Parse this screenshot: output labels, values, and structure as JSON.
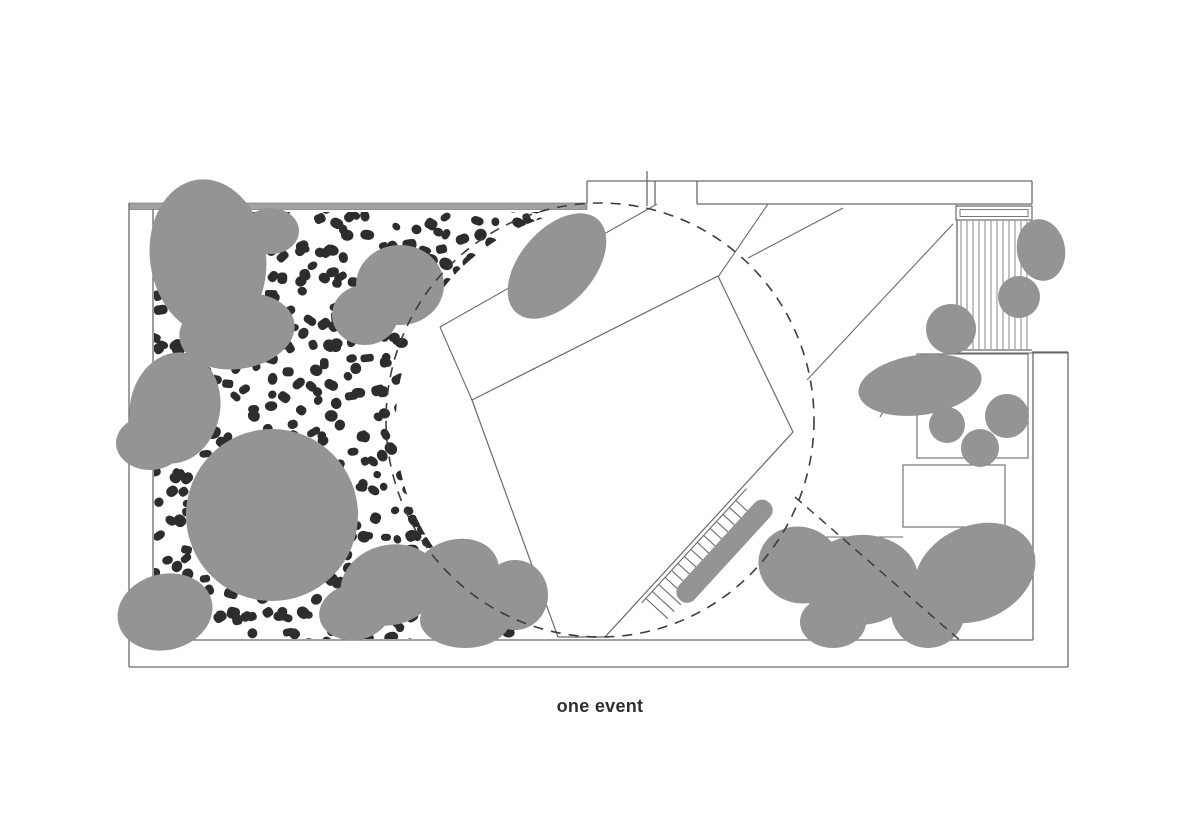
{
  "caption": {
    "text": "one event"
  },
  "palette": {
    "background": "#ffffff",
    "canopy": "#949494",
    "gravel": "#2d2d2d",
    "line": "#6a6a6a",
    "line_light": "#8a8a8a",
    "dash": "#3d3d3d",
    "band": "#a2a2a2",
    "caption": "#2f2f2f"
  },
  "plan": {
    "boundary_lines": [
      [
        129,
        203,
        129,
        667
      ],
      [
        129,
        667,
        1068,
        667
      ],
      [
        1068,
        667,
        1068,
        352
      ],
      [
        1068,
        352,
        1032,
        352
      ],
      [
        153,
        209,
        153,
        640
      ],
      [
        153,
        640,
        1033,
        640
      ],
      [
        1033,
        640,
        1033,
        353
      ],
      [
        587,
        203,
        587,
        181
      ],
      [
        587,
        181,
        655,
        181
      ],
      [
        655,
        181,
        1032,
        181
      ],
      [
        1032,
        181,
        1032,
        204
      ],
      [
        697,
        204,
        1032,
        204
      ],
      [
        655,
        181,
        655,
        205
      ],
      [
        697,
        181,
        697,
        204
      ],
      [
        647,
        171,
        647,
        206
      ],
      [
        957,
        205,
        957,
        352
      ],
      [
        957,
        350,
        1032,
        350
      ]
    ],
    "top_band": {
      "x": 129,
      "y": 203,
      "w": 458,
      "h": 6.5
    },
    "path_lines": [
      [
        440,
        327,
        657,
        204
      ],
      [
        440,
        327,
        472,
        400
      ],
      [
        718,
        277,
        768,
        204
      ],
      [
        748,
        258,
        843,
        208
      ],
      [
        953,
        224,
        807,
        380
      ],
      [
        880,
        417,
        917,
        355
      ],
      [
        778,
        537,
        903,
        537
      ]
    ],
    "beds": [
      {
        "x": 917,
        "y": 354,
        "w": 111,
        "h": 104
      },
      {
        "x": 903,
        "y": 465,
        "w": 102,
        "h": 62
      }
    ],
    "bench": {
      "outer": [
        956,
        206,
        76,
        14
      ],
      "inner": [
        960,
        209.5,
        68,
        7
      ]
    },
    "deck": {
      "x0": 961,
      "x1": 1028,
      "step": 6,
      "y0": 221,
      "y1": 349
    },
    "platform": [
      [
        472,
        400
      ],
      [
        718,
        276
      ],
      [
        793,
        432
      ],
      [
        605,
        637
      ],
      [
        558,
        637
      ]
    ],
    "stairs": {
      "origin": [
        605,
        637
      ],
      "dir": [
        0.676,
        -0.737
      ],
      "normal": [
        0.737,
        0.676
      ],
      "rail": {
        "s0": 50,
        "s1": 205,
        "off": 4
      },
      "treads": {
        "s0": 56,
        "s1": 198,
        "step": 9.5,
        "off0": 4,
        "off1": 34
      },
      "bar": {
        "s0": 78,
        "s1": 210,
        "off": 30,
        "halfw": 10.5,
        "round": 10
      }
    },
    "gravel": {
      "clip_path": "M154,212 L566,212 A214,217 0 0 0 517,620 L517,639 L154,639 Z",
      "seed": 20240,
      "x0": 150,
      "x1": 612,
      "y0": 208,
      "y1": 641,
      "step": 16,
      "jitter": 11,
      "skip": 0.14,
      "wmin": 7.5,
      "wmax": 14.5,
      "hmin": 7,
      "hmax": 12
    },
    "canopies": [
      [
        208,
        257,
        58,
        78,
        -8
      ],
      [
        271,
        231,
        28,
        23,
        0
      ],
      [
        237,
        331,
        58,
        38,
        -8
      ],
      [
        400,
        285,
        44,
        40,
        0
      ],
      [
        365,
        315,
        33,
        30,
        0
      ],
      [
        175,
        408,
        45,
        56,
        12
      ],
      [
        150,
        443,
        34,
        27,
        0
      ],
      [
        272,
        515,
        86,
        86,
        0
      ],
      [
        165,
        612,
        48,
        38,
        -14
      ],
      [
        557,
        266,
        62,
        37,
        -49
      ],
      [
        390,
        585,
        50,
        40,
        -15
      ],
      [
        455,
        575,
        45,
        35,
        -20
      ],
      [
        515,
        595,
        33,
        35,
        0
      ],
      [
        465,
        620,
        45,
        28,
        0
      ],
      [
        355,
        612,
        36,
        28,
        -10
      ],
      [
        800,
        565,
        42,
        38,
        20
      ],
      [
        860,
        580,
        58,
        45,
        -5
      ],
      [
        833,
        622,
        33,
        26,
        0
      ],
      [
        928,
        611,
        37,
        37,
        0
      ],
      [
        975,
        573,
        63,
        47,
        -25
      ],
      [
        951,
        329,
        25,
        25,
        0
      ],
      [
        920,
        385,
        62,
        30,
        -8
      ],
      [
        947,
        425,
        18,
        18,
        0
      ],
      [
        980,
        448,
        19,
        19,
        0
      ],
      [
        1007,
        416,
        22,
        22,
        0
      ],
      [
        1041,
        250,
        24,
        31,
        -10
      ],
      [
        1019,
        297,
        21,
        21,
        0
      ]
    ],
    "event_circle": {
      "cx": 600,
      "cy": 420,
      "rx": 214,
      "ry": 217,
      "dash": "10 8",
      "width": 1.6
    },
    "dashed_lines": [
      [
        795,
        497,
        963,
        643
      ]
    ]
  }
}
